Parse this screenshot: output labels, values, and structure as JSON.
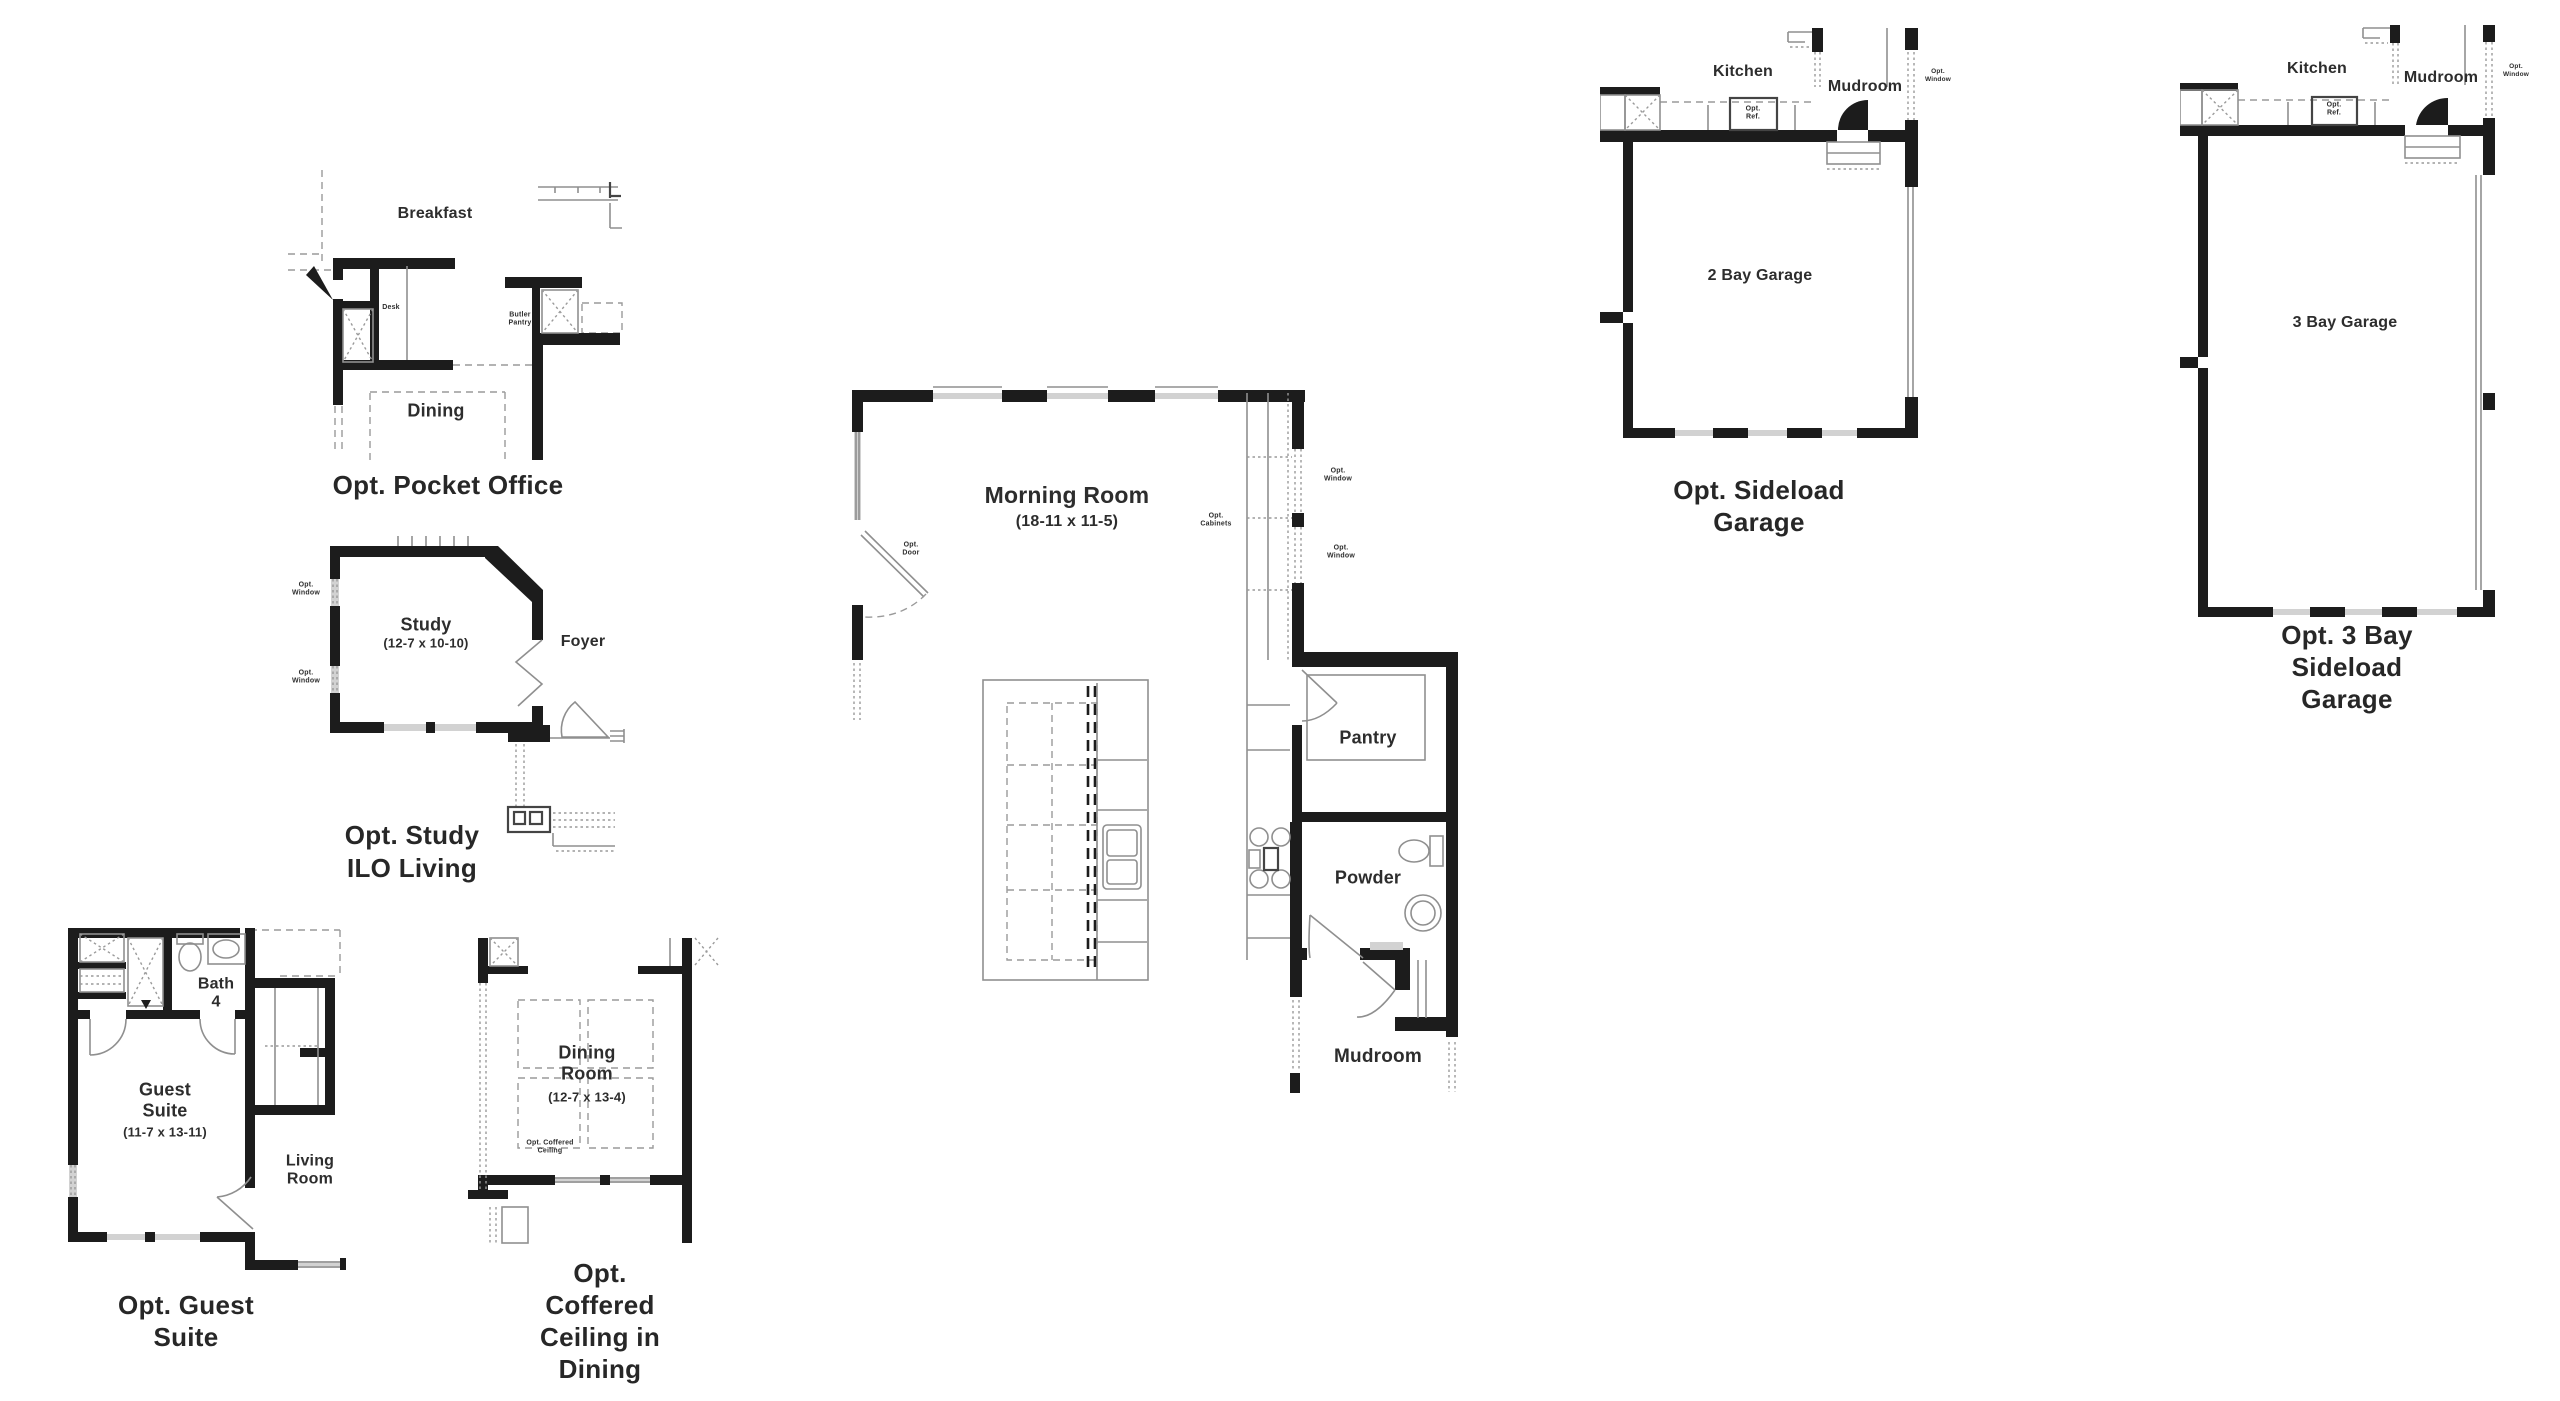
{
  "colors": {
    "wall": "#1c1c1c",
    "thin_line": "#8f8f8f",
    "window": "#d2d2d2",
    "text": "#2d2d2d"
  },
  "plans": {
    "pocket_office": {
      "title": "Opt. Pocket Office",
      "labels": {
        "breakfast": "Breakfast",
        "desk": "Desk",
        "butler_pantry": "Butler\nPantry",
        "dining": "Dining"
      }
    },
    "study_ilo_living": {
      "title": "Opt. Study\nILO Living",
      "labels": {
        "opt_window_top": "Opt.\nWindow",
        "opt_window_bottom": "Opt.\nWindow",
        "study": "Study",
        "study_dims": "(12-7 x 10-10)",
        "foyer": "Foyer"
      }
    },
    "guest_suite": {
      "title": "Opt. Guest Suite",
      "labels": {
        "bath4": "Bath\n4",
        "guest_suite": "Guest\nSuite",
        "guest_suite_dims": "(11-7 x 13-11)",
        "living_room": "Living\nRoom"
      }
    },
    "coffered_dining": {
      "title": "Opt. Coffered\nCeiling in Dining",
      "labels": {
        "dining_room": "Dining\nRoom",
        "dining_room_dims": "(12-7 x 13-4)",
        "opt_coffered_ceiling": "Opt. Coffered\nCeiling"
      }
    },
    "morning_room": {
      "labels": {
        "morning_room": "Morning Room",
        "morning_room_dims": "(18-11 x 11-5)",
        "opt_door": "Opt.\nDoor",
        "opt_cabinets": "Opt.\nCabinets",
        "opt_window_upper": "Opt.\nWindow",
        "opt_window_lower": "Opt.\nWindow",
        "pantry": "Pantry",
        "powder": "Powder",
        "mudroom": "Mudroom"
      }
    },
    "sideload_garage": {
      "title": "Opt. Sideload Garage",
      "labels": {
        "kitchen": "Kitchen",
        "mudroom": "Mudroom",
        "opt_ref": "Opt.\nRef.",
        "opt_window": "Opt.\nWindow",
        "garage": "2 Bay Garage"
      }
    },
    "three_bay_sideload_garage": {
      "title": "Opt. 3 Bay Sideload\nGarage",
      "labels": {
        "kitchen": "Kitchen",
        "mudroom": "Mudroom",
        "opt_ref": "Opt.\nRef.",
        "opt_window": "Opt.\nWindow",
        "garage": "3 Bay Garage"
      }
    }
  }
}
